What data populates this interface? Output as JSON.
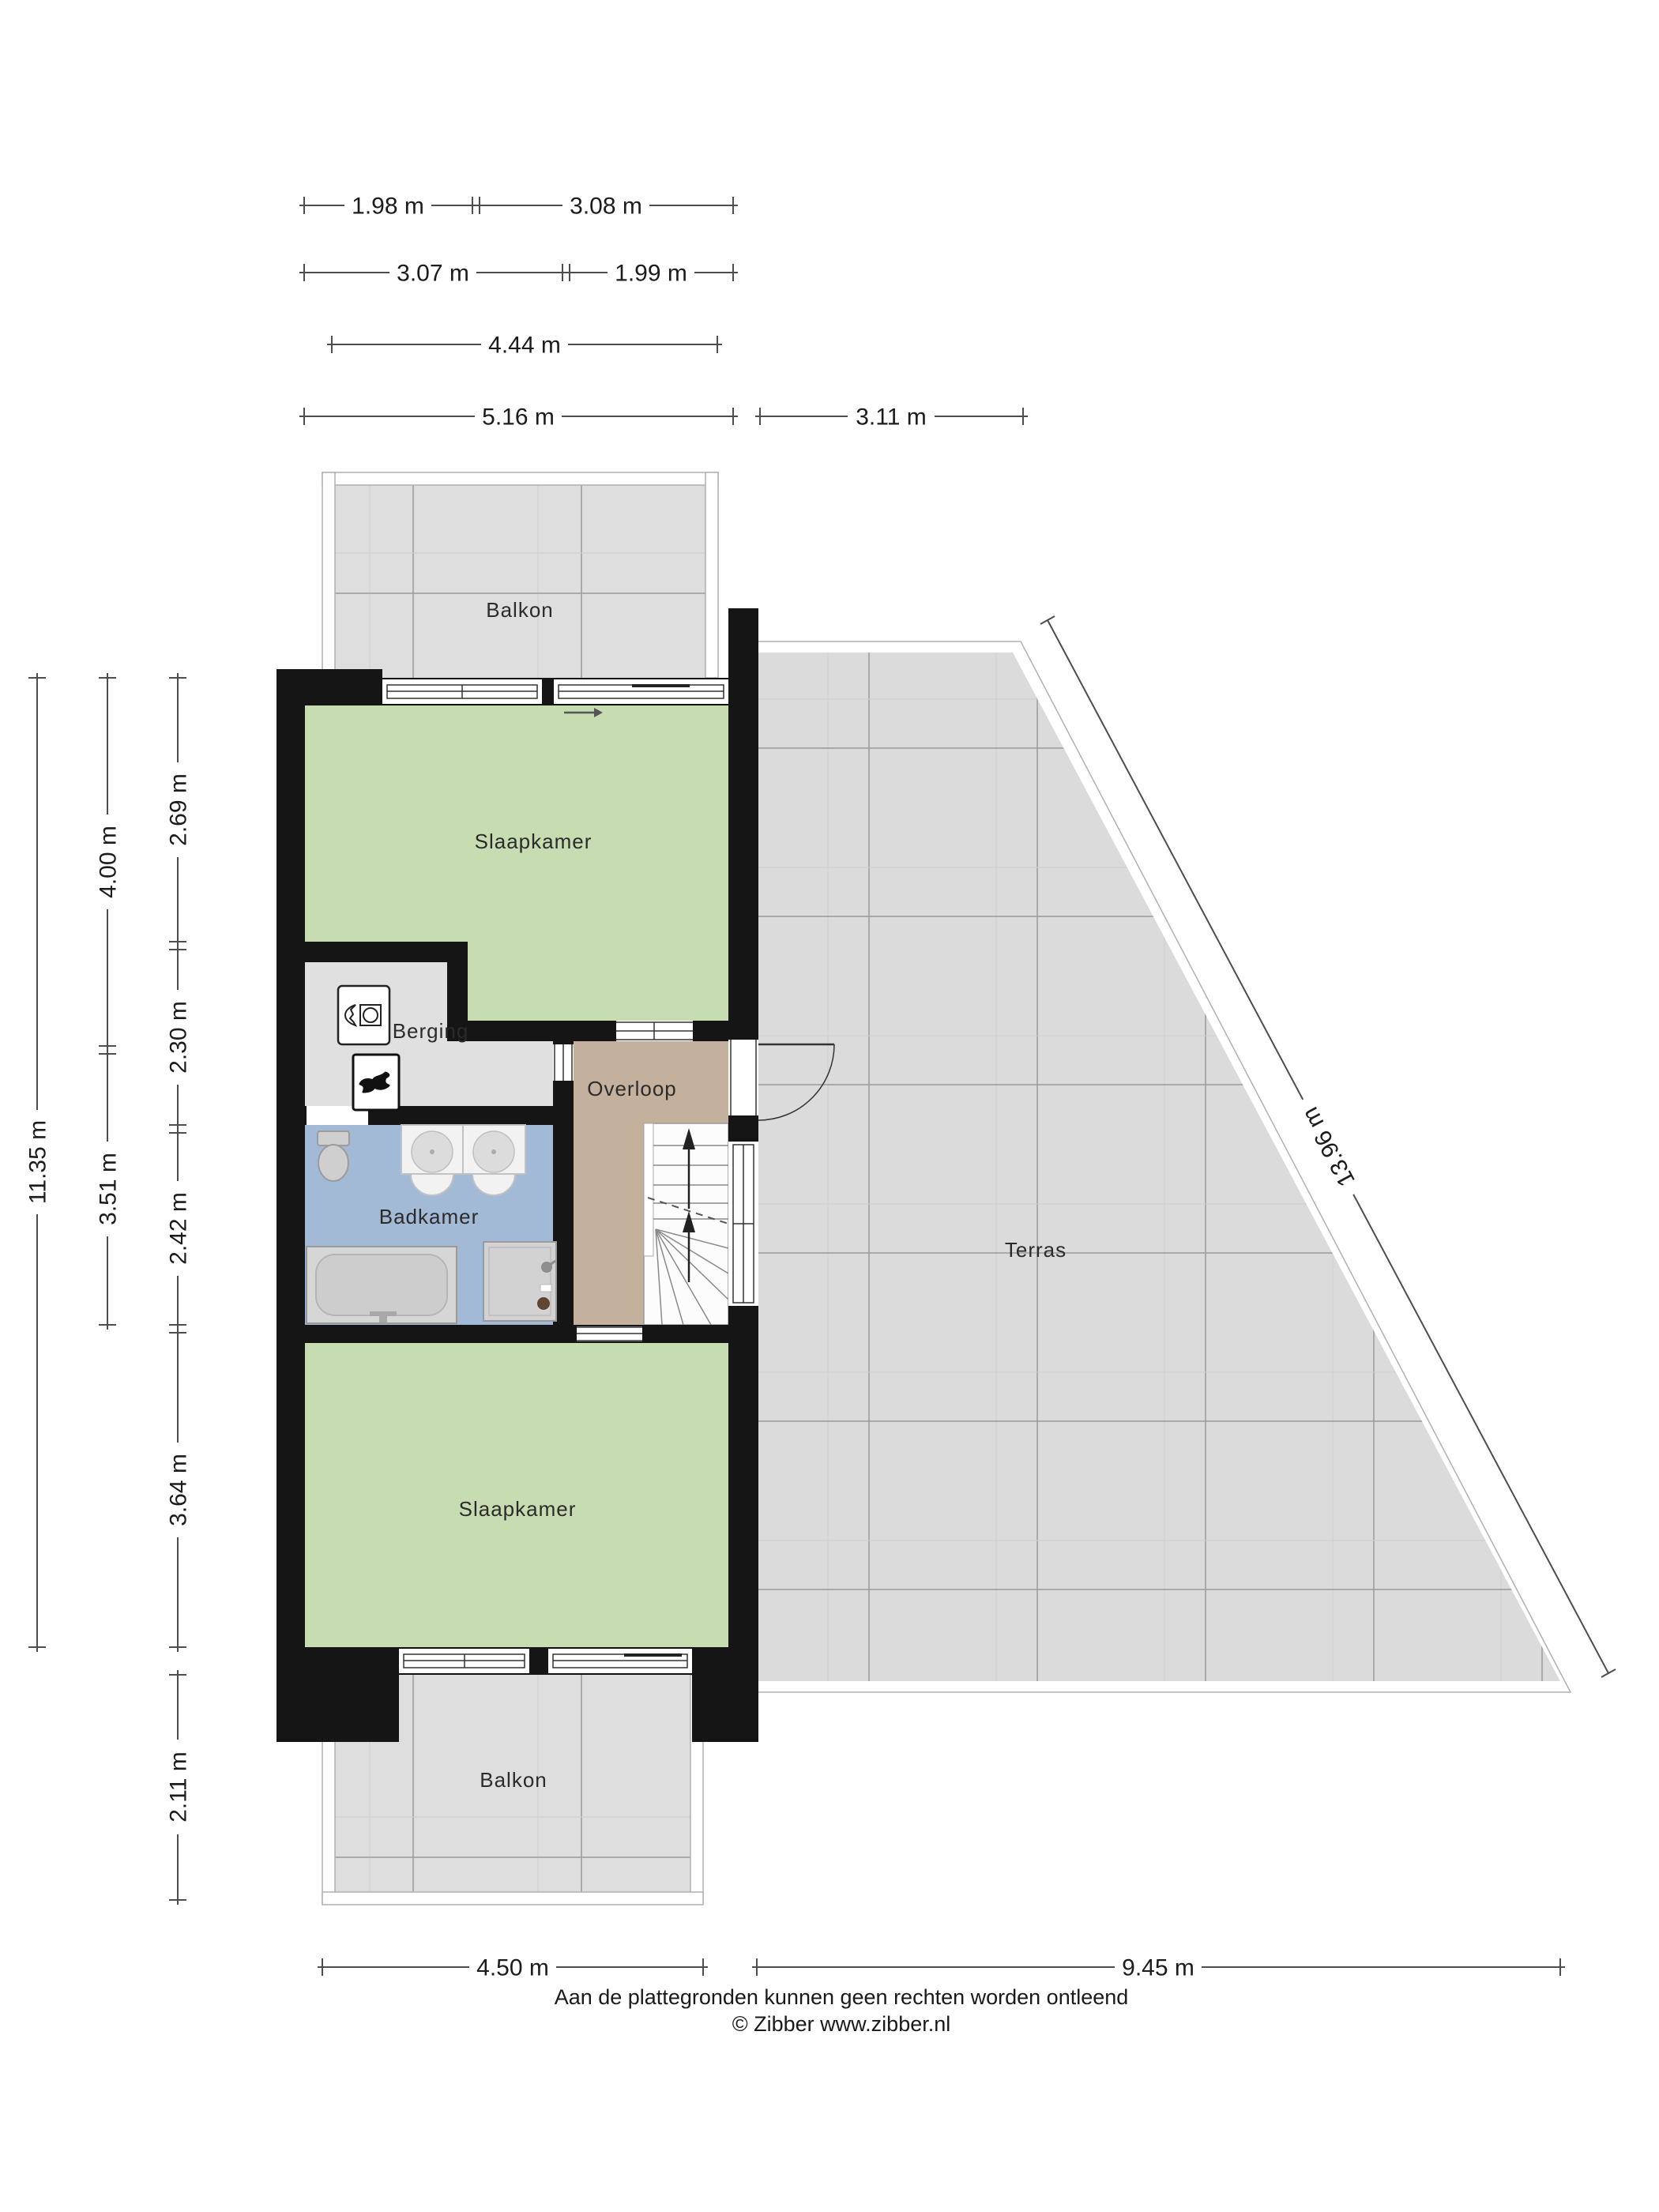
{
  "rooms": {
    "balkon_top": "Balkon",
    "slaapkamer_top": "Slaapkamer",
    "berging": "Berging",
    "overloop": "Overloop",
    "badkamer": "Badkamer",
    "terras": "Terras",
    "slaapkamer_bottom": "Slaapkamer",
    "balkon_bottom": "Balkon"
  },
  "dims": {
    "t1a": "1.98 m",
    "t1b": "3.08 m",
    "t2a": "3.07 m",
    "t2b": "1.99 m",
    "t3": "4.44 m",
    "t4a": "5.16 m",
    "t4b": "3.11 m",
    "l1": "11.35 m",
    "l2a": "4.00 m",
    "l2b": "3.51 m",
    "l3a": "2.69 m",
    "l3b": "2.30 m",
    "l3c": "2.42 m",
    "l3d": "3.64 m",
    "l3e": "2.11 m",
    "b1": "4.50 m",
    "b2": "9.45 m",
    "diag": "13.96 m"
  },
  "footer": {
    "line1": "Aan de plattegronden kunnen geen rechten worden ontleend",
    "line2": "© Zibber www.zibber.nl"
  },
  "colors": {
    "wall": "#151515",
    "green": "#c8dcb2",
    "blue": "#a3bad6",
    "tan": "#c3b19e",
    "gray": "#e0e0e0",
    "terras": "#dbdbdb",
    "stairs": "#fcfcfc"
  },
  "icons": [
    "washing-machine",
    "boiler-flame",
    "toilet",
    "double-washbasin",
    "bathtub",
    "shower",
    "staircase-up-arrows",
    "door-swing",
    "sliding-door-arrow"
  ]
}
